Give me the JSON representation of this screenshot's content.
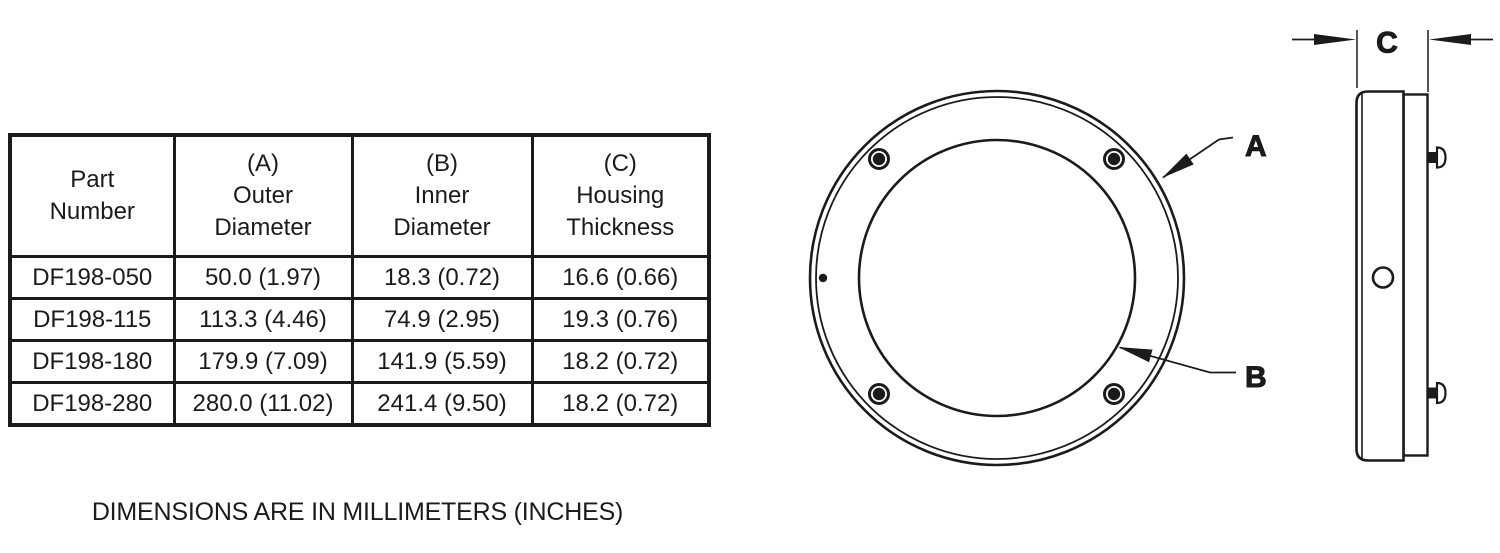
{
  "page": {
    "background": "#ffffff",
    "ink": "#1b1b1b"
  },
  "table": {
    "headers": [
      "Part\nNumber",
      "(A)\nOuter\nDiameter",
      "(B)\nInner\nDiameter",
      "(C)\nHousing\nThickness"
    ],
    "rows": [
      [
        "DF198-050",
        "50.0 (1.97)",
        "18.3 (0.72)",
        "16.6 (0.66)"
      ],
      [
        "DF198-115",
        "113.3 (4.46)",
        "74.9 (2.95)",
        "19.3 (0.76)"
      ],
      [
        "DF198-180",
        "179.9 (7.09)",
        "141.9 (5.59)",
        "18.2 (0.72)"
      ],
      [
        "DF198-280",
        "280.0 (11.02)",
        "241.4 (9.50)",
        "18.2 (0.72)"
      ]
    ]
  },
  "caption": "DIMENSIONS ARE IN MILLIMETERS (INCHES)",
  "drawing": {
    "front_view": {
      "outer_diameter_label": "A",
      "inner_diameter_label": "B"
    },
    "side_view": {
      "thickness_label": "C"
    }
  }
}
